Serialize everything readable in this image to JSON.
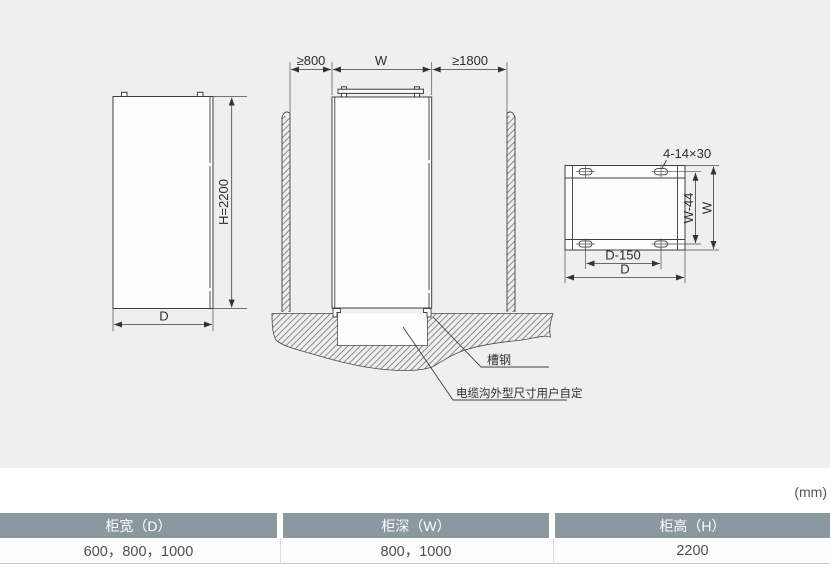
{
  "page": {
    "units_label": "(mm)",
    "canvas_bg": "#efefef"
  },
  "diagram": {
    "side_view": {
      "height_dim": "H=2200",
      "depth_dim": "D"
    },
    "front_view": {
      "left_clearance_dim": "≥800",
      "width_dim": "W",
      "right_clearance_dim": "≥1800",
      "channel_steel_label": "槽钢",
      "cable_trench_label": "电缆沟外型尺寸用户自定"
    },
    "base_view": {
      "mounting_holes_dim": "4-14×30",
      "hole_pitch_depth_dim": "W-44",
      "depth_dim": "W",
      "hole_pitch_width_dim": "D-150",
      "width_dim": "D"
    }
  },
  "table": {
    "columns": [
      {
        "header": "柜宽（D）",
        "value": "600，800，1000"
      },
      {
        "header": "柜深（W）",
        "value": "800，1000"
      },
      {
        "header": "柜高（H）",
        "value": "2200"
      }
    ]
  },
  "colors": {
    "table_header_bg": "#8a98a0",
    "table_header_text": "#ffffff",
    "line": "#3f3f3f"
  }
}
